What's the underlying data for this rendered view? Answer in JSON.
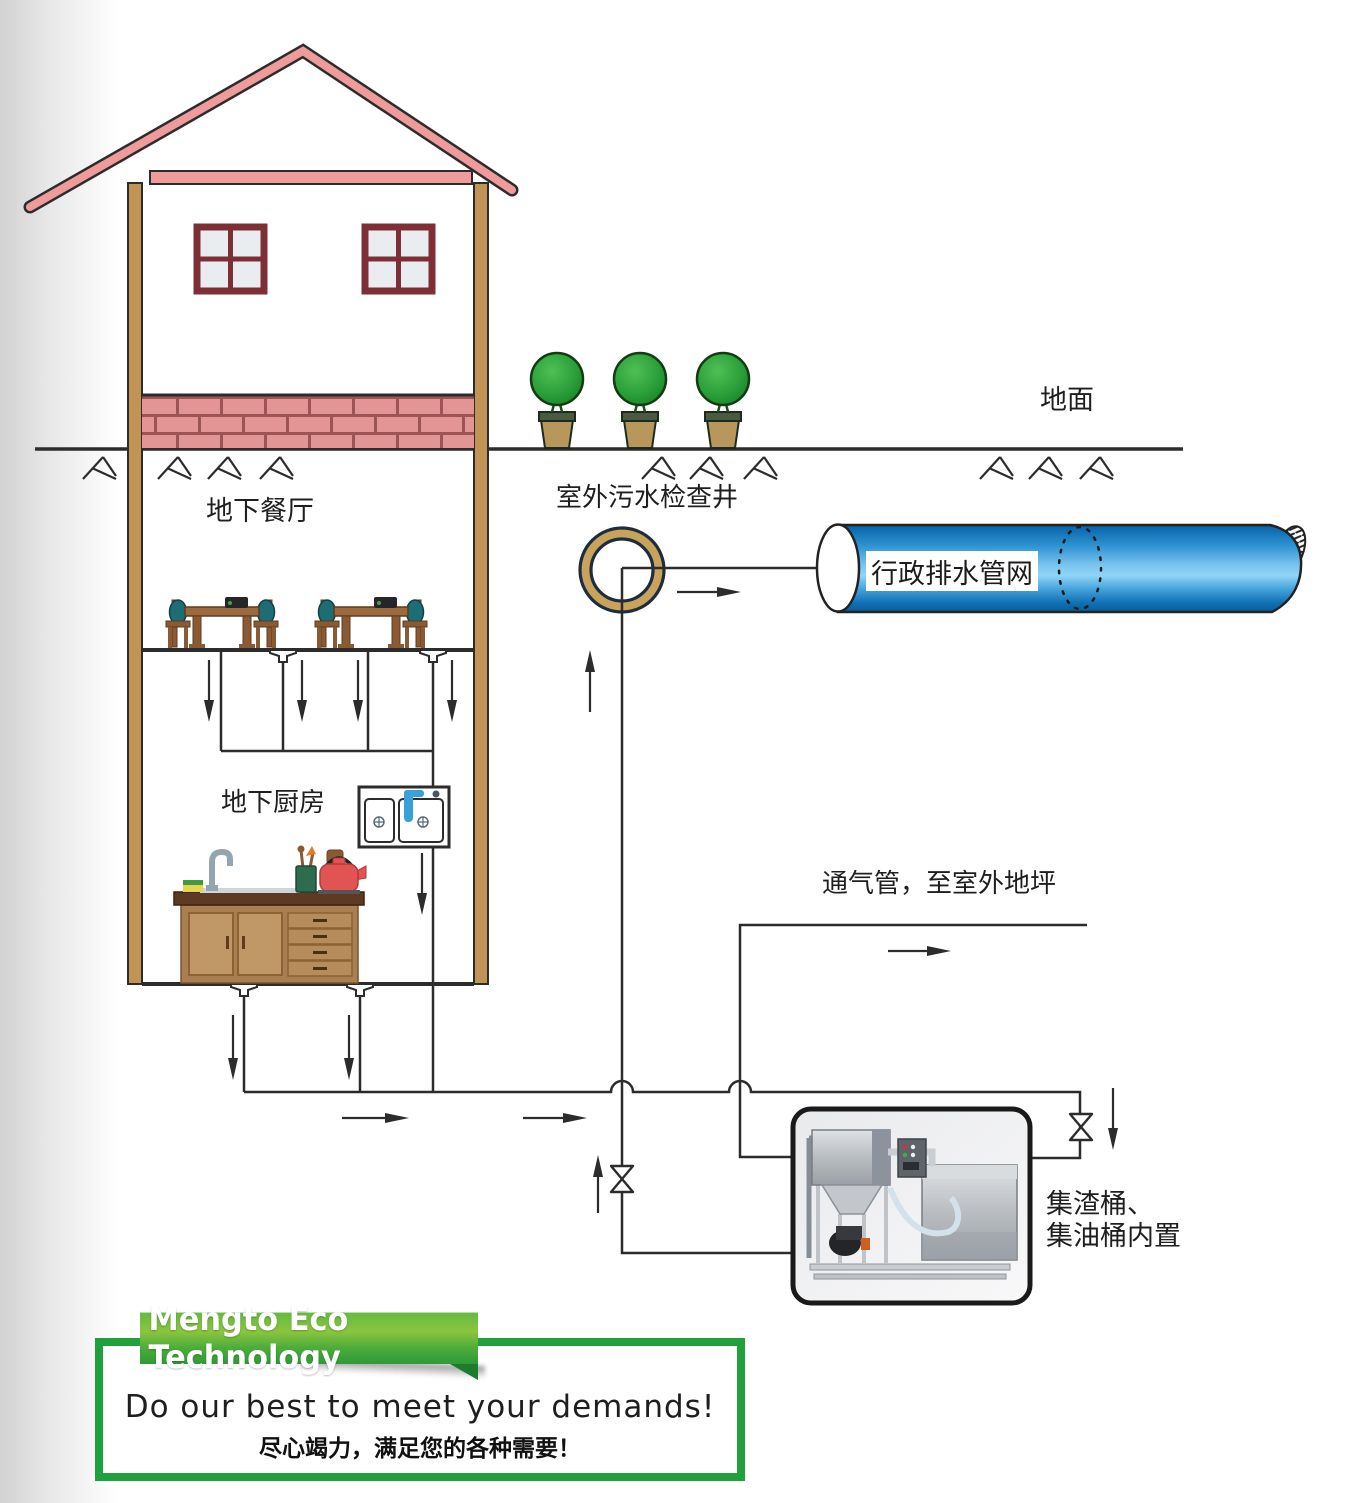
{
  "diagram": {
    "labels": {
      "ground": "地面",
      "well": "室外污水检查井",
      "municipal": "行政排水管网",
      "restaurant": "地下餐厅",
      "kitchen": "地下厨房",
      "vent": "通气管，至室外地坪",
      "equipment1": "集渣桶、",
      "equipment2": "集油桶内置"
    },
    "colors": {
      "line_dark": "#2c2c2c",
      "pipe_blue": "#2f93d1",
      "well_ring_tan": "#c8a35b",
      "roof_pink": "#ef9b9b",
      "wall_tan": "#c19455",
      "brick_salmon": "#e39494",
      "tree_green": "#2ca03a",
      "chair_teal": "#1d6e74",
      "kettle_red": "#e25454",
      "accent_green": "#21a13d"
    },
    "icons": {
      "house": "house-illustration",
      "trees": "potted-tree-icon",
      "well": "inspection-well-icon",
      "valves": "valve-icon",
      "arrows": "flow-arrow-icon",
      "equipment": "grease-trap-equipment"
    }
  },
  "banner": {
    "brand": "Mengto Eco Technology",
    "slogan_en": "Do our best to meet your demands!",
    "slogan_zh": "尽心竭力，满足您的各种需要！"
  }
}
